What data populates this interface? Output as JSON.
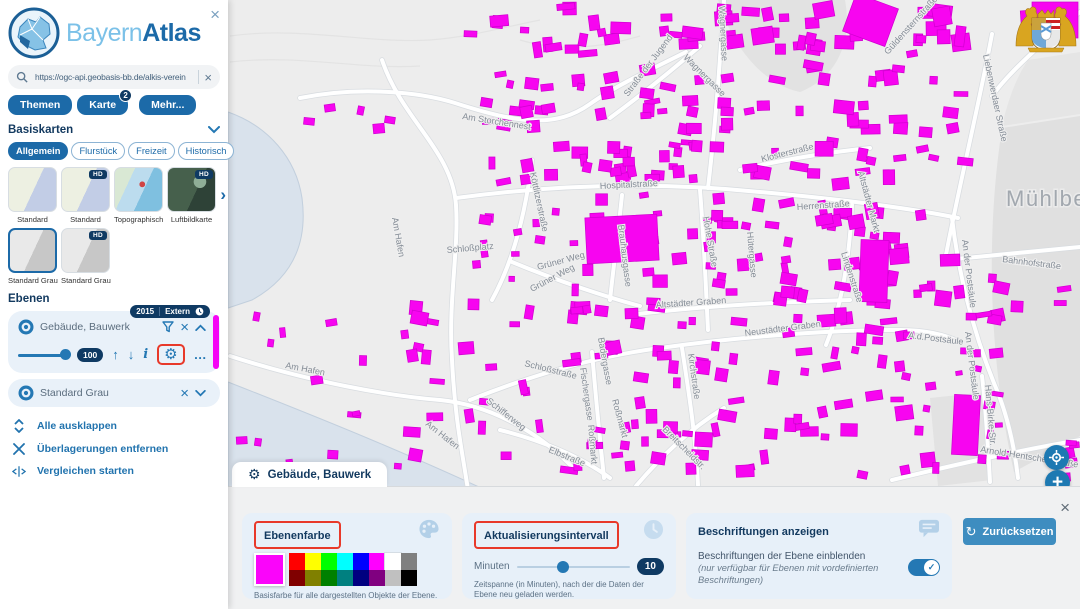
{
  "glyphs": {
    "close": "×",
    "more_dots": "…",
    "up": "↑",
    "down": "↓",
    "info": "i",
    "gear": "⚙",
    "next": "›",
    "plus": "+",
    "check": "✓",
    "reset": "↻"
  },
  "panel": {
    "logo": {
      "light": "Bayern",
      "bold": "Atlas"
    },
    "search": {
      "value": "https://ogc-api.geobasis-bb.de/alkis-verein"
    },
    "nav": [
      {
        "label": "Themen"
      },
      {
        "label": "Karte",
        "badge": "2"
      },
      {
        "label": "Mehr..."
      }
    ],
    "basiskarten": {
      "title": "Basiskarten",
      "hd_label": "HD",
      "chips": [
        {
          "label": "Allgemein",
          "active": true
        },
        {
          "label": "Flurstück",
          "active": false
        },
        {
          "label": "Freizeit",
          "active": false
        },
        {
          "label": "Historisch",
          "active": false
        }
      ],
      "thumbs": [
        {
          "label": "Standard",
          "kind": "standard",
          "hd": false,
          "selected": false
        },
        {
          "label": "Standard",
          "kind": "standard",
          "hd": true,
          "selected": false
        },
        {
          "label": "Topographisch",
          "kind": "topo",
          "hd": false,
          "selected": false
        },
        {
          "label": "Luftbildkarte",
          "kind": "aerial",
          "hd": true,
          "selected": false
        },
        {
          "label": "Standard Grau",
          "kind": "gray",
          "hd": false,
          "selected": true
        },
        {
          "label": "Standard Grau",
          "kind": "gray",
          "hd": true,
          "selected": false
        }
      ]
    },
    "ebenen": {
      "title": "Ebenen",
      "layer1": {
        "name": "Gebäude, Bauwerk",
        "year_badge": "2015",
        "extern_badge": "Extern",
        "opacity_badge": "100"
      },
      "layer2": {
        "name": "Standard Grau"
      },
      "links": [
        {
          "label": "Alle ausklappen",
          "icon": "expand"
        },
        {
          "label": "Überlagerungen entfernen",
          "icon": "close"
        },
        {
          "label": "Vergleichen starten",
          "icon": "compare"
        }
      ]
    }
  },
  "settings": {
    "tab_title": "Gebäude, Bauwerk",
    "reset_label": "Zurücksetzen",
    "farbe": {
      "title": "Ebenenfarbe",
      "caption": "Basisfarbe für alle dargestellten Objekte der Ebene.",
      "current": "#fa05fa",
      "row1": [
        "#ff0000",
        "#ffff00",
        "#00ff00",
        "#00ffff",
        "#0000ff",
        "#ff00ff",
        "#ffffff",
        "#808080"
      ],
      "row2": [
        "#800000",
        "#808000",
        "#008000",
        "#008080",
        "#000080",
        "#800080",
        "#c0c0c0",
        "#000000"
      ]
    },
    "intervall": {
      "title": "Aktualisierungsintervall",
      "unit": "Minuten",
      "value": "10",
      "caption": "Zeitspanne (in Minuten), nach der die Daten der Ebene neu geladen werden."
    },
    "beschriftungen": {
      "title": "Beschriftungen anzeigen",
      "line1": "Beschriftungen der Ebene einblenden",
      "line2": "(nur verfügbar für Ebenen mit vordefinierten Beschriftungen)",
      "enabled": true
    }
  },
  "map": {
    "place_label": "Mühlberg",
    "building_color": "#f705f0",
    "street_labels": [
      {
        "t": "Am Storchennest",
        "x": 462,
        "y": 119,
        "r": 9
      },
      {
        "t": "Am Hafen",
        "x": 392,
        "y": 218,
        "r": 80
      },
      {
        "t": "Schloßplatz",
        "x": 447,
        "y": 253,
        "r": -5
      },
      {
        "t": "Straße der Jugend",
        "x": 628,
        "y": 97,
        "r": -53
      },
      {
        "t": "Wagnergasse",
        "x": 683,
        "y": 58,
        "r": 45
      },
      {
        "t": "Wagnergasse",
        "x": 719,
        "y": 6,
        "r": 87
      },
      {
        "t": "Güldensternstraße",
        "x": 888,
        "y": 55,
        "r": -48
      },
      {
        "t": "Liebenwerdaer Straße",
        "x": 983,
        "y": 55,
        "r": 78
      },
      {
        "t": "Klosterstraße",
        "x": 762,
        "y": 162,
        "r": -14
      },
      {
        "t": "Hospitalstraße",
        "x": 600,
        "y": 189,
        "r": -3
      },
      {
        "t": "Herrenstraße",
        "x": 797,
        "y": 210,
        "r": -4
      },
      {
        "t": "Köttlitzerstraße",
        "x": 530,
        "y": 173,
        "r": 78
      },
      {
        "t": "Brauhausgasse",
        "x": 618,
        "y": 225,
        "r": 83
      },
      {
        "t": "Hohe Straße",
        "x": 703,
        "y": 217,
        "r": 80
      },
      {
        "t": "Hütergasse",
        "x": 747,
        "y": 232,
        "r": 85
      },
      {
        "t": "Altstädter Markt",
        "x": 858,
        "y": 172,
        "r": 75
      },
      {
        "t": "Lindenstraße",
        "x": 841,
        "y": 253,
        "r": 72
      },
      {
        "t": "Grüner Weg",
        "x": 538,
        "y": 270,
        "r": -15
      },
      {
        "t": "Grüner Weg",
        "x": 532,
        "y": 292,
        "r": -28
      },
      {
        "t": "Altstädter Graben",
        "x": 656,
        "y": 308,
        "r": -4
      },
      {
        "t": "Neustädter Graben",
        "x": 745,
        "y": 336,
        "r": -7
      },
      {
        "t": "Schloßstraße",
        "x": 524,
        "y": 366,
        "r": 14
      },
      {
        "t": "Badergasse",
        "x": 598,
        "y": 338,
        "r": 80
      },
      {
        "t": "Fischergasse",
        "x": 580,
        "y": 368,
        "r": 82
      },
      {
        "t": "Roßmarkt",
        "x": 612,
        "y": 400,
        "r": 75
      },
      {
        "t": "Roßmarkt",
        "x": 588,
        "y": 425,
        "r": 85
      },
      {
        "t": "Elbstraße",
        "x": 548,
        "y": 452,
        "r": 22
      },
      {
        "t": "Schifferweg",
        "x": 486,
        "y": 402,
        "r": 38
      },
      {
        "t": "Am Hafen",
        "x": 285,
        "y": 368,
        "r": 11
      },
      {
        "t": "Am Hafen",
        "x": 425,
        "y": 425,
        "r": 38
      },
      {
        "t": "Kirchstraße",
        "x": 688,
        "y": 354,
        "r": 82
      },
      {
        "t": "Breitscheidstr.",
        "x": 662,
        "y": 430,
        "r": 45
      },
      {
        "t": "A.d.Postsäule",
        "x": 908,
        "y": 338,
        "r": 7
      },
      {
        "t": "An der Postsäule",
        "x": 962,
        "y": 240,
        "r": 83
      },
      {
        "t": "An der Postsäule",
        "x": 965,
        "y": 332,
        "r": 83
      },
      {
        "t": "Bahnhofstraße",
        "x": 1002,
        "y": 262,
        "r": 7
      },
      {
        "t": "Hans-Birke-Str.",
        "x": 985,
        "y": 385,
        "r": 85
      },
      {
        "t": "Arnold-Hentschel-Straße",
        "x": 980,
        "y": 452,
        "r": 9
      }
    ],
    "clusters": [
      {
        "x": 455,
        "y": 2,
        "w": 190,
        "h": 58,
        "n": 16,
        "min": 7,
        "max": 20
      },
      {
        "x": 650,
        "y": 0,
        "w": 240,
        "h": 55,
        "n": 30,
        "min": 7,
        "max": 22
      },
      {
        "x": 895,
        "y": 0,
        "w": 90,
        "h": 60,
        "n": 10,
        "min": 8,
        "max": 26
      },
      {
        "x": 1020,
        "y": 0,
        "w": 58,
        "h": 45,
        "n": 6,
        "min": 10,
        "max": 24
      },
      {
        "x": 470,
        "y": 65,
        "w": 160,
        "h": 75,
        "n": 18,
        "min": 6,
        "max": 16
      },
      {
        "x": 470,
        "y": 140,
        "w": 310,
        "h": 45,
        "n": 34,
        "min": 6,
        "max": 16
      },
      {
        "x": 640,
        "y": 60,
        "w": 150,
        "h": 80,
        "n": 20,
        "min": 6,
        "max": 16
      },
      {
        "x": 790,
        "y": 60,
        "w": 120,
        "h": 130,
        "n": 26,
        "min": 7,
        "max": 20
      },
      {
        "x": 915,
        "y": 70,
        "w": 60,
        "h": 100,
        "n": 8,
        "min": 6,
        "max": 16
      },
      {
        "x": 470,
        "y": 190,
        "w": 110,
        "h": 60,
        "n": 8,
        "min": 5,
        "max": 12
      },
      {
        "x": 560,
        "y": 190,
        "w": 140,
        "h": 140,
        "n": 30,
        "min": 6,
        "max": 17
      },
      {
        "x": 700,
        "y": 190,
        "w": 110,
        "h": 150,
        "n": 30,
        "min": 6,
        "max": 16
      },
      {
        "x": 810,
        "y": 195,
        "w": 150,
        "h": 140,
        "n": 34,
        "min": 7,
        "max": 20
      },
      {
        "x": 300,
        "y": 85,
        "w": 140,
        "h": 50,
        "n": 5,
        "min": 5,
        "max": 12
      },
      {
        "x": 440,
        "y": 240,
        "w": 80,
        "h": 90,
        "n": 6,
        "min": 5,
        "max": 14
      },
      {
        "x": 380,
        "y": 300,
        "w": 170,
        "h": 170,
        "n": 22,
        "min": 6,
        "max": 18
      },
      {
        "x": 250,
        "y": 300,
        "w": 130,
        "h": 120,
        "n": 8,
        "min": 5,
        "max": 14
      },
      {
        "x": 550,
        "y": 335,
        "w": 230,
        "h": 150,
        "n": 44,
        "min": 6,
        "max": 18
      },
      {
        "x": 780,
        "y": 330,
        "w": 170,
        "h": 150,
        "n": 30,
        "min": 6,
        "max": 18
      },
      {
        "x": 950,
        "y": 270,
        "w": 130,
        "h": 60,
        "n": 10,
        "min": 6,
        "max": 16
      },
      {
        "x": 950,
        "y": 340,
        "w": 60,
        "h": 140,
        "n": 12,
        "min": 5,
        "max": 14
      },
      {
        "x": 1020,
        "y": 440,
        "w": 60,
        "h": 42,
        "n": 6,
        "min": 6,
        "max": 14
      },
      {
        "x": 230,
        "y": 430,
        "w": 120,
        "h": 52,
        "n": 5,
        "min": 5,
        "max": 12
      }
    ],
    "big_buildings": [
      {
        "x": 586,
        "y": 216,
        "w": 72,
        "h": 46,
        "r": -3
      },
      {
        "x": 848,
        "y": 0,
        "w": 45,
        "h": 40,
        "r": 20
      },
      {
        "x": 1032,
        "y": 2,
        "w": 46,
        "h": 36,
        "r": 0
      },
      {
        "x": 953,
        "y": 395,
        "w": 26,
        "h": 60,
        "r": 3
      },
      {
        "x": 860,
        "y": 240,
        "w": 28,
        "h": 62,
        "r": 2
      }
    ]
  }
}
